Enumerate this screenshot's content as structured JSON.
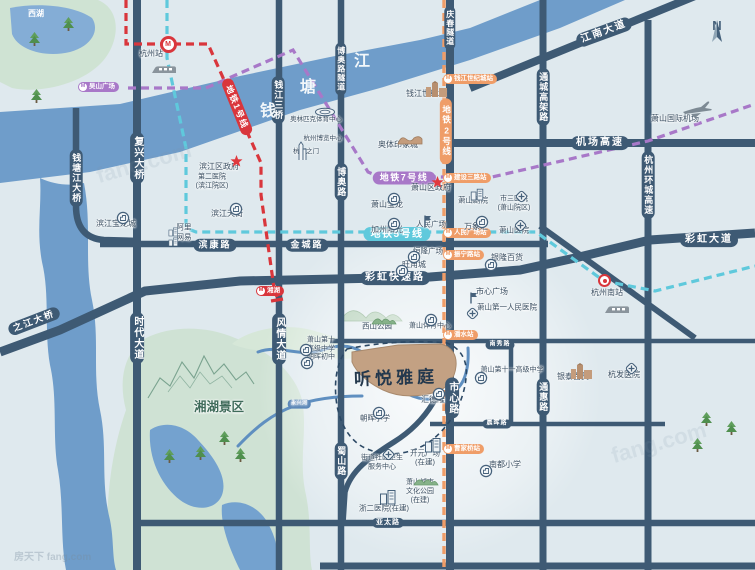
{
  "map": {
    "compass_letter": "N",
    "property": {
      "name": "听悦雅庭",
      "fill": "#c3a183"
    },
    "colors": {
      "road": "#3e5a74",
      "river": "#6f9dca",
      "line1": "#d9363c",
      "line2": "#ef9d68",
      "line5": "#5fc9dc",
      "line7": "#a878c8"
    },
    "metro_labels": [
      {
        "t": "地铁1号线",
        "x": 237,
        "y": 107,
        "bg": "#d9363c",
        "rot": 68,
        "s": 8.5
      },
      {
        "t": "地铁2号线",
        "x": 446,
        "y": 131,
        "bg": "#ef9d68",
        "vertical": true,
        "s": 8.5
      },
      {
        "t": "地铁5号线",
        "x": 397,
        "y": 234,
        "bg": "#5fc9dc",
        "s": 10
      },
      {
        "t": "地铁7号线",
        "x": 404,
        "y": 178,
        "bg": "#a878c8",
        "s": 9
      }
    ],
    "stations": [
      {
        "t": "吴山广场",
        "x": 78,
        "y": 82,
        "bg": "#a878c8",
        "type": "cap"
      },
      {
        "t": "湘湖",
        "x": 256,
        "y": 286,
        "bg": "#d9363c",
        "type": "cap"
      },
      {
        "t": "钱江世纪城站",
        "x": 443,
        "y": 74,
        "bg": "#ef9d68",
        "type": "cap"
      },
      {
        "t": "建设三路站",
        "x": 443,
        "y": 173,
        "bg": "#ef9d68",
        "type": "cap"
      },
      {
        "t": "人民广场站",
        "x": 443,
        "y": 228,
        "bg": "#ef9d68",
        "type": "cap"
      },
      {
        "t": "振宁路站",
        "x": 443,
        "y": 250,
        "bg": "#ef9d68",
        "type": "cap"
      },
      {
        "t": "潘水站",
        "x": 443,
        "y": 330,
        "bg": "#ef9d68",
        "type": "cap"
      },
      {
        "t": "曹家桥站",
        "x": 443,
        "y": 444,
        "bg": "#ef9d68",
        "type": "cap"
      },
      {
        "t": "M",
        "x": 168,
        "y": 44,
        "type": "ring"
      },
      {
        "t": "",
        "x": 605,
        "y": 281,
        "type": "target"
      }
    ],
    "road_labels": [
      {
        "t": "钱塘江大桥",
        "x": 76,
        "y": 178,
        "o": "v",
        "s": 9
      },
      {
        "t": "复兴大桥",
        "x": 137,
        "y": 158,
        "o": "v",
        "s": 10
      },
      {
        "t": "时代大道",
        "x": 137,
        "y": 338,
        "o": "v",
        "s": 10
      },
      {
        "t": "钱江三桥",
        "x": 278,
        "y": 100,
        "o": "v",
        "s": 9
      },
      {
        "t": "风情大道",
        "x": 279,
        "y": 339,
        "o": "v",
        "s": 10
      },
      {
        "t": "博奥路隧道",
        "x": 341,
        "y": 69,
        "o": "v",
        "s": 8
      },
      {
        "t": "博奥路",
        "x": 341,
        "y": 182,
        "o": "v",
        "s": 9
      },
      {
        "t": "蜀山路",
        "x": 341,
        "y": 461,
        "o": "v",
        "s": 9
      },
      {
        "t": "庆春隧道",
        "x": 450,
        "y": 28,
        "o": "v",
        "s": 8
      },
      {
        "t": "市心路",
        "x": 452,
        "y": 398,
        "o": "v",
        "s": 10
      },
      {
        "t": "通城高架路",
        "x": 543,
        "y": 97,
        "o": "v",
        "s": 9
      },
      {
        "t": "通惠路",
        "x": 543,
        "y": 397,
        "o": "v",
        "s": 9
      },
      {
        "t": "杭州环城高速",
        "x": 648,
        "y": 185,
        "o": "v",
        "s": 9
      },
      {
        "t": "江南大道",
        "x": 604,
        "y": 32,
        "o": "h",
        "rot": -20,
        "s": 10
      },
      {
        "t": "机场高速",
        "x": 600,
        "y": 143,
        "o": "h",
        "s": 10
      },
      {
        "t": "彩虹大道",
        "x": 709,
        "y": 240,
        "o": "h",
        "s": 10
      },
      {
        "t": "彩虹快速路",
        "x": 395,
        "y": 278,
        "o": "h",
        "s": 10
      },
      {
        "t": "滨康路",
        "x": 215,
        "y": 245,
        "o": "h",
        "s": 9
      },
      {
        "t": "金城路",
        "x": 307,
        "y": 245,
        "o": "h",
        "s": 9
      },
      {
        "t": "之江大桥",
        "x": 34,
        "y": 321,
        "o": "h",
        "rot": -21,
        "s": 9
      },
      {
        "t": "南秀路",
        "x": 500,
        "y": 345,
        "o": "h",
        "s": 6,
        "minor": true
      },
      {
        "t": "晨晖路",
        "x": 497,
        "y": 424,
        "o": "h",
        "s": 6,
        "minor": true
      },
      {
        "t": "亚太路",
        "x": 388,
        "y": 523,
        "o": "h",
        "s": 7,
        "minor": true
      }
    ],
    "pois": [
      {
        "t": "西湖",
        "x": 36,
        "y": 14,
        "s": 8,
        "cls": "white"
      },
      {
        "t": "钱",
        "x": 268,
        "y": 112,
        "cls": "riverchar"
      },
      {
        "t": "塘",
        "x": 308,
        "y": 88,
        "cls": "riverchar"
      },
      {
        "t": "江",
        "x": 362,
        "y": 62,
        "cls": "riverchar"
      },
      {
        "t": "杭州站",
        "x": 151,
        "y": 54,
        "s": 8
      },
      {
        "t": "奥林匹克体育中心",
        "x": 316,
        "y": 120,
        "s": 6.5
      },
      {
        "t": "杭州博览中心",
        "x": 323,
        "y": 139,
        "s": 6.5
      },
      {
        "t": "杭州之门",
        "x": 306,
        "y": 152,
        "s": 6.5
      },
      {
        "t": "钱江世纪城",
        "x": 426,
        "y": 94,
        "s": 8
      },
      {
        "t": "奥体印象城",
        "x": 398,
        "y": 145,
        "s": 8
      },
      {
        "t": "萧山国际机场",
        "x": 675,
        "y": 119,
        "s": 8
      },
      {
        "t": "滨江区政府",
        "x": 219,
        "y": 167,
        "s": 8
      },
      {
        "lines": [
          "第二医院",
          "(滨江院区)"
        ],
        "x": 212,
        "y": 182,
        "s": 7
      },
      {
        "t": "滨江天街",
        "x": 227,
        "y": 214,
        "s": 8
      },
      {
        "t": "滨江宝龙城",
        "x": 116,
        "y": 224,
        "s": 8
      },
      {
        "t": "阿里",
        "x": 184,
        "y": 227,
        "s": 7.5
      },
      {
        "t": "网易",
        "x": 184,
        "y": 237,
        "s": 7.5
      },
      {
        "t": "萧山宝龙",
        "x": 387,
        "y": 205,
        "s": 8
      },
      {
        "t": "加州阳光",
        "x": 387,
        "y": 230,
        "s": 8
      },
      {
        "t": "萧山区政府",
        "x": 431,
        "y": 188,
        "s": 8
      },
      {
        "t": "人民广场",
        "x": 431,
        "y": 224,
        "s": 7.5
      },
      {
        "t": "萧山剧院",
        "x": 473,
        "y": 200,
        "s": 7.5
      },
      {
        "t": "万象汇",
        "x": 476,
        "y": 227,
        "s": 8
      },
      {
        "lines": [
          "市三医院",
          "(萧山院区)"
        ],
        "x": 514,
        "y": 204,
        "s": 7
      },
      {
        "t": "萧山医院",
        "x": 514,
        "y": 230,
        "s": 7.5
      },
      {
        "t": "恒隆广场",
        "x": 428,
        "y": 251,
        "s": 7.5
      },
      {
        "t": "旺角城",
        "x": 414,
        "y": 265,
        "s": 8
      },
      {
        "t": "银隆百货",
        "x": 507,
        "y": 258,
        "s": 8
      },
      {
        "t": "市心广场",
        "x": 492,
        "y": 292,
        "s": 8
      },
      {
        "t": "萧山第一人民医院",
        "x": 507,
        "y": 307,
        "s": 7.5
      },
      {
        "t": "杭州南站",
        "x": 607,
        "y": 293,
        "s": 8
      },
      {
        "t": "银泰百货",
        "x": 573,
        "y": 377,
        "s": 8
      },
      {
        "t": "杭发医院",
        "x": 624,
        "y": 375,
        "s": 8
      },
      {
        "t": "萧山第十一高级中学",
        "x": 512,
        "y": 371,
        "s": 7
      },
      {
        "t": "南都小学",
        "x": 505,
        "y": 465,
        "s": 8
      },
      {
        "t": "西山公园",
        "x": 377,
        "y": 326,
        "s": 7.5
      },
      {
        "t": "萧山体育中心",
        "x": 430,
        "y": 327,
        "s": 7
      },
      {
        "lines": [
          "萧山第十",
          "高级中学"
        ],
        "x": 321,
        "y": 345,
        "s": 7
      },
      {
        "t": "朝晖初中",
        "x": 321,
        "y": 358,
        "s": 7
      },
      {
        "t": "汇德隆",
        "x": 433,
        "y": 400,
        "s": 8
      },
      {
        "t": "朝晖小学",
        "x": 375,
        "y": 418,
        "s": 7.5
      },
      {
        "t": "湘湖景区",
        "x": 219,
        "y": 408,
        "s": 12.5,
        "cls": "scenic"
      },
      {
        "lines": [
          "街道社区卫生",
          "服务中心"
        ],
        "x": 382,
        "y": 463,
        "s": 7
      },
      {
        "lines": [
          "开元广场",
          "(在建)"
        ],
        "x": 425,
        "y": 458,
        "s": 7.5
      },
      {
        "lines": [
          "萧山城市",
          "文化公园",
          "(在建)"
        ],
        "x": 420,
        "y": 492,
        "s": 7
      },
      {
        "t": "浙二医院(在建)",
        "x": 384,
        "y": 508,
        "s": 7.5
      },
      {
        "t": "永兴河",
        "x": 299,
        "y": 404,
        "cls": "rivlab"
      }
    ],
    "icons": [
      {
        "type": "train-icon",
        "x": 151,
        "y": 64
      },
      {
        "type": "train-icon",
        "x": 604,
        "y": 304
      },
      {
        "type": "plane-icon",
        "x": 681,
        "y": 100
      },
      {
        "type": "stadium-icon",
        "x": 314,
        "y": 107
      },
      {
        "type": "tower-icon",
        "x": 297,
        "y": 141
      },
      {
        "type": "tan-buildings-icon",
        "x": 425,
        "y": 80
      },
      {
        "type": "tan-buildings-icon",
        "x": 570,
        "y": 362
      },
      {
        "type": "mall-wave-icon",
        "x": 397,
        "y": 131
      },
      {
        "type": "gov-star-icon",
        "x": 230,
        "y": 155
      },
      {
        "type": "gov-star-icon",
        "x": 431,
        "y": 176
      },
      {
        "type": "plaza-flag-icon",
        "x": 422,
        "y": 214
      },
      {
        "type": "plaza-flag-icon",
        "x": 468,
        "y": 291
      },
      {
        "type": "hospital-cross-icon",
        "x": 514,
        "y": 189
      },
      {
        "type": "hospital-cross-icon",
        "x": 513,
        "y": 218
      },
      {
        "type": "hospital-cross-icon",
        "x": 465,
        "y": 306
      },
      {
        "type": "hospital-cross-icon",
        "x": 624,
        "y": 361
      },
      {
        "type": "hospital-cross-icon",
        "x": 381,
        "y": 447
      },
      {
        "type": "poi-circle-icon",
        "x": 229,
        "y": 202
      },
      {
        "type": "poi-circle-icon",
        "x": 116,
        "y": 211
      },
      {
        "type": "poi-circle-icon",
        "x": 387,
        "y": 192
      },
      {
        "type": "poi-circle-icon",
        "x": 387,
        "y": 217
      },
      {
        "type": "poi-circle-icon",
        "x": 475,
        "y": 215
      },
      {
        "type": "poi-circle-icon",
        "x": 407,
        "y": 250
      },
      {
        "type": "poi-circle-icon",
        "x": 395,
        "y": 264
      },
      {
        "type": "poi-circle-icon",
        "x": 484,
        "y": 258
      },
      {
        "type": "poi-circle-icon",
        "x": 474,
        "y": 371
      },
      {
        "type": "poi-circle-icon",
        "x": 479,
        "y": 464
      },
      {
        "type": "poi-circle-icon",
        "x": 424,
        "y": 313
      },
      {
        "type": "poi-circle-icon",
        "x": 299,
        "y": 343
      },
      {
        "type": "poi-circle-icon",
        "x": 300,
        "y": 356
      },
      {
        "type": "poi-circle-icon",
        "x": 432,
        "y": 387
      },
      {
        "type": "poi-circle-icon",
        "x": 372,
        "y": 406
      },
      {
        "type": "gray-building-icon",
        "x": 168,
        "y": 227,
        "sc": 0.6
      },
      {
        "type": "gray-building-icon",
        "x": 168,
        "y": 237,
        "sc": 0.6
      },
      {
        "type": "gray-building-icon",
        "x": 470,
        "y": 188,
        "sc": 0.8
      },
      {
        "type": "gray-building-icon",
        "x": 424,
        "y": 437
      },
      {
        "type": "gray-building-icon",
        "x": 379,
        "y": 489
      },
      {
        "type": "hills-icon",
        "x": 371,
        "y": 313
      },
      {
        "type": "hills-icon",
        "x": 413,
        "y": 474
      }
    ],
    "trees": [
      [
        28,
        32
      ],
      [
        62,
        17
      ],
      [
        30,
        89
      ],
      [
        163,
        449
      ],
      [
        194,
        446
      ],
      [
        234,
        448
      ],
      [
        218,
        431
      ],
      [
        700,
        412
      ],
      [
        725,
        421
      ],
      [
        691,
        438
      ]
    ],
    "watermarks": {
      "ghost1": "fang.com",
      "ghost2": "fang.com",
      "corner": "房天下 fang.com"
    }
  }
}
